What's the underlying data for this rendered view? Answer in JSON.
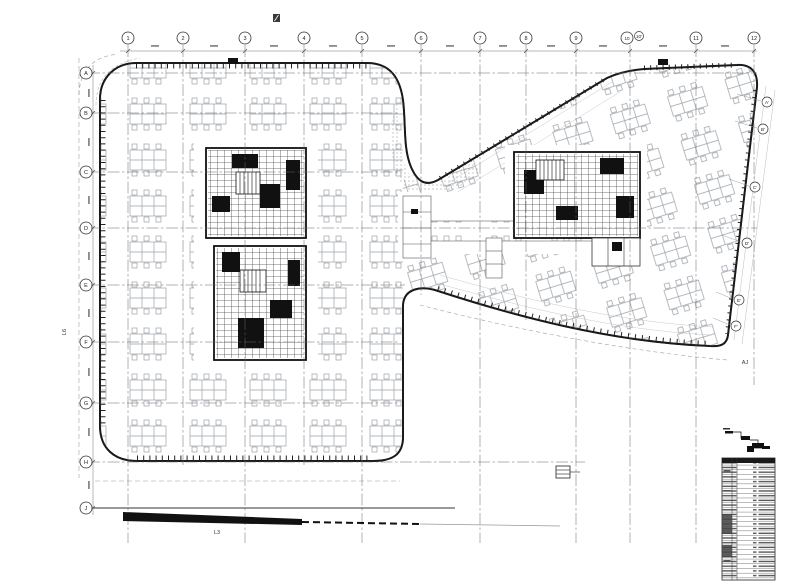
{
  "grid": {
    "columns": [
      {
        "label": "1"
      },
      {
        "label": "2"
      },
      {
        "label": "3"
      },
      {
        "label": "4"
      },
      {
        "label": "5"
      },
      {
        "label": "6"
      },
      {
        "label": "7"
      },
      {
        "label": "8"
      },
      {
        "label": "9"
      },
      {
        "label": "10"
      },
      {
        "label": "10'"
      },
      {
        "label": "11"
      },
      {
        "label": "12"
      }
    ],
    "rows_left": [
      {
        "label": "A"
      },
      {
        "label": "B"
      },
      {
        "label": "C"
      },
      {
        "label": "D"
      },
      {
        "label": "E"
      },
      {
        "label": "F"
      },
      {
        "label": "G"
      },
      {
        "label": "H"
      },
      {
        "label": "J"
      }
    ],
    "rows_right": [
      {
        "label": "A'"
      },
      {
        "label": "B'"
      },
      {
        "label": "C'"
      },
      {
        "label": "D'"
      },
      {
        "label": "E'"
      },
      {
        "label": "F'"
      }
    ]
  },
  "annotations": {
    "left_margin": "L6",
    "bottom_margin": "L3",
    "right_margin": "AJ"
  },
  "colors": {
    "line": "#1a1a1a",
    "grid": "#666666",
    "furniture": "#9aa0a6",
    "muted": "#999999"
  }
}
